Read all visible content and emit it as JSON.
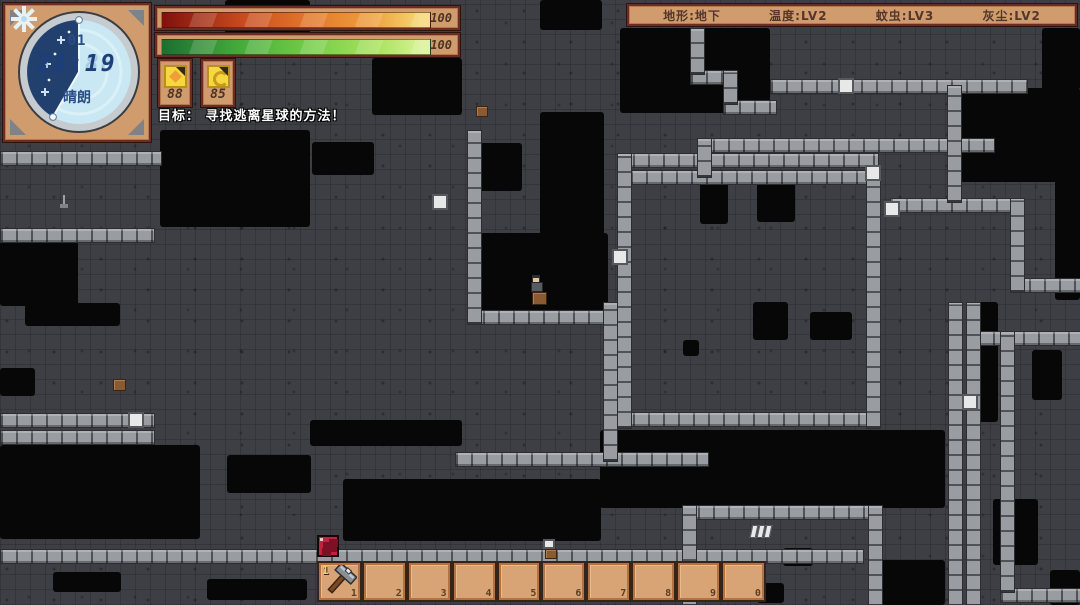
{
  "hud": {
    "clock": {
      "day": "01",
      "time": "21:19",
      "time_ghost": "88:88",
      "weather": "晴朗",
      "weather_icon": "snowflake-icon"
    },
    "bars": [
      {
        "name": "health",
        "value": "100",
        "gradient": [
          "#7e120c",
          "#c84b1e",
          "#e2782b",
          "#ee9e3c",
          "#f6d875"
        ]
      },
      {
        "name": "energy",
        "value": "100",
        "gradient": [
          "#1d6e31",
          "#44a93a",
          "#74cc47",
          "#a8e25e",
          "#d8f295"
        ]
      }
    ],
    "meters": [
      {
        "name": "hunger",
        "icon": "food-icon",
        "value": "88"
      },
      {
        "name": "thirst",
        "icon": "water-icon",
        "value": "85"
      }
    ],
    "goal": "目标： 寻找逃离星球的方法！",
    "status": [
      {
        "text": "地形:地下"
      },
      {
        "text": "温度:LV2"
      },
      {
        "text": "蚊虫:LV3"
      },
      {
        "text": "灰尘:LV2"
      }
    ]
  },
  "hotbar": {
    "selected_indicator": "1",
    "slots": [
      {
        "key": "1",
        "item": "stone-axe"
      },
      {
        "key": "2",
        "item": null
      },
      {
        "key": "3",
        "item": null
      },
      {
        "key": "4",
        "item": null
      },
      {
        "key": "5",
        "item": null
      },
      {
        "key": "6",
        "item": null
      },
      {
        "key": "7",
        "item": null
      },
      {
        "key": "8",
        "item": null
      },
      {
        "key": "9",
        "item": null
      },
      {
        "key": "0",
        "item": null
      }
    ]
  },
  "map": {
    "colors": {
      "rock": "#3d3f44",
      "void": "#070708",
      "wall": "#999ca1",
      "block": "#e7e8e8",
      "frame": "#d09c6d",
      "frame_border": "#6d2b26"
    },
    "voids": [
      [
        225,
        0,
        85,
        57
      ],
      [
        540,
        0,
        62,
        30
      ],
      [
        620,
        28,
        150,
        85
      ],
      [
        160,
        130,
        150,
        97
      ],
      [
        372,
        58,
        90,
        57
      ],
      [
        312,
        142,
        62,
        33
      ],
      [
        477,
        143,
        45,
        48
      ],
      [
        960,
        88,
        120,
        94
      ],
      [
        1042,
        28,
        38,
        62
      ],
      [
        1055,
        88,
        25,
        212
      ],
      [
        480,
        233,
        128,
        80
      ],
      [
        540,
        112,
        64,
        192
      ],
      [
        700,
        182,
        28,
        42
      ],
      [
        757,
        182,
        38,
        40
      ],
      [
        0,
        241,
        78,
        65
      ],
      [
        25,
        303,
        95,
        23
      ],
      [
        0,
        368,
        35,
        28
      ],
      [
        0,
        445,
        200,
        94
      ],
      [
        227,
        455,
        84,
        38
      ],
      [
        310,
        420,
        152,
        26
      ],
      [
        343,
        479,
        258,
        62
      ],
      [
        600,
        430,
        345,
        78
      ],
      [
        753,
        302,
        35,
        38
      ],
      [
        810,
        312,
        42,
        28
      ],
      [
        683,
        340,
        16,
        16
      ],
      [
        53,
        572,
        68,
        20
      ],
      [
        207,
        579,
        100,
        21
      ],
      [
        870,
        560,
        75,
        45
      ],
      [
        1032,
        350,
        30,
        50
      ],
      [
        993,
        499,
        45,
        66
      ],
      [
        1050,
        570,
        30,
        35
      ],
      [
        978,
        302,
        20,
        120
      ],
      [
        783,
        548,
        30,
        18
      ],
      [
        757,
        583,
        27,
        20
      ]
    ],
    "walls_h": [
      [
        0,
        151,
        160
      ],
      [
        0,
        228,
        153
      ],
      [
        467,
        310,
        146
      ],
      [
        0,
        413,
        153
      ],
      [
        0,
        430,
        153
      ],
      [
        455,
        452,
        252
      ],
      [
        0,
        549,
        862
      ],
      [
        770,
        79,
        256
      ],
      [
        697,
        138,
        296
      ],
      [
        617,
        153,
        260
      ],
      [
        630,
        170,
        236
      ],
      [
        890,
        198,
        122
      ],
      [
        1013,
        278,
        67
      ],
      [
        617,
        412,
        262
      ],
      [
        682,
        505,
        190
      ],
      [
        977,
        331,
        103
      ],
      [
        1000,
        588,
        80
      ],
      [
        690,
        70,
        35
      ],
      [
        723,
        100,
        52
      ]
    ],
    "walls_v": [
      [
        467,
        130,
        193
      ],
      [
        603,
        302,
        158
      ],
      [
        617,
        153,
        274
      ],
      [
        866,
        170,
        257
      ],
      [
        947,
        85,
        116
      ],
      [
        1010,
        198,
        93
      ],
      [
        948,
        302,
        303
      ],
      [
        966,
        302,
        303
      ],
      [
        682,
        505,
        100
      ],
      [
        868,
        505,
        100
      ],
      [
        1000,
        331,
        260
      ],
      [
        690,
        28,
        45
      ],
      [
        723,
        70,
        33
      ],
      [
        697,
        138,
        38
      ]
    ],
    "white_blocks": [
      [
        128,
        412
      ],
      [
        838,
        78
      ],
      [
        865,
        165
      ],
      [
        612,
        249
      ],
      [
        884,
        201
      ],
      [
        962,
        394
      ],
      [
        432,
        194
      ]
    ],
    "sprites": {
      "player": {
        "x": 530,
        "y": 275
      },
      "player_pack": {
        "x": 532,
        "y": 292,
        "w": 13,
        "h": 11
      },
      "red_crystal": {
        "x": 317,
        "y": 535
      },
      "crate_a": {
        "x": 476,
        "y": 106,
        "w": 10,
        "h": 9
      },
      "crate_b": {
        "x": 113,
        "y": 379,
        "w": 11,
        "h": 10
      },
      "plant": {
        "x": 59,
        "y": 195
      },
      "ore_bars": {
        "x": 751,
        "y": 523
      },
      "chest_white": {
        "x": 543,
        "y": 539,
        "w": 12,
        "h": 10
      }
    }
  }
}
